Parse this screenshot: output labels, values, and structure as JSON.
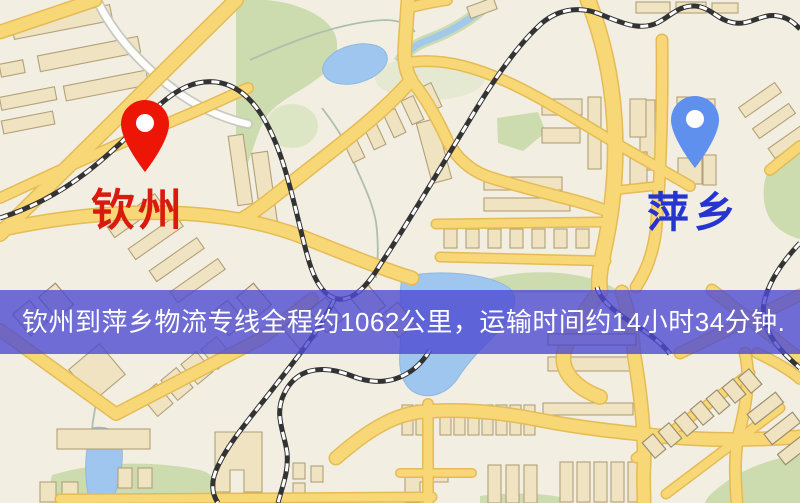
{
  "map": {
    "origin_marker": {
      "label": "钦州",
      "pin_color": "#ed1506",
      "label_color": "#d91a0c"
    },
    "destination_marker": {
      "label": "萍乡",
      "pin_color": "#5f90ee",
      "label_color": "#2634d0"
    },
    "route_banner": {
      "text": "钦州到萍乡物流专线全程约1062公里，运输时间约14小时34分钟.",
      "background": "#4d4bd2",
      "text_color": "#ffffff"
    },
    "palette": {
      "background": "#f2eee2",
      "road_fill": "#f8d777",
      "road_casing": "#e5bb55",
      "park": "#ccdcae",
      "park_light": "#dde6c4",
      "water": "#9fc6ee",
      "building_fill": "#efe3c2",
      "building_stroke": "#b2a077",
      "railway_dark": "#333333",
      "railway_light": "#ffffff",
      "stream": "#aebfae"
    }
  }
}
